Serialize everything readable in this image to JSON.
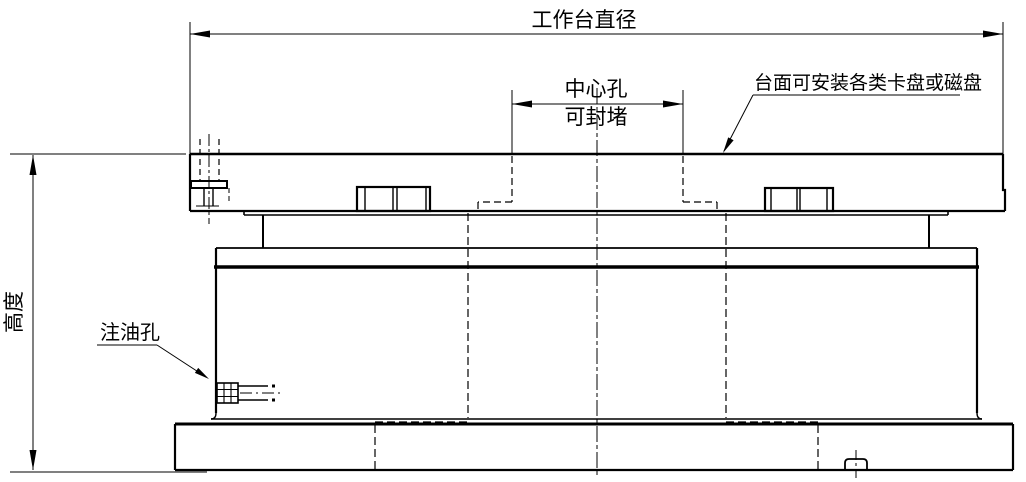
{
  "drawing": {
    "title": "rotary-worktable-section-drawing",
    "background": "#ffffff",
    "line_color": "#000000",
    "labels": {
      "worktable_diameter": "工作台直径",
      "center_hole_line1": "中心孔",
      "center_hole_line2": "可封堵",
      "height": "高度",
      "table_surface_note": "台面可安装各类卡盘或磁盘",
      "oil_hole": "注油孔"
    }
  }
}
